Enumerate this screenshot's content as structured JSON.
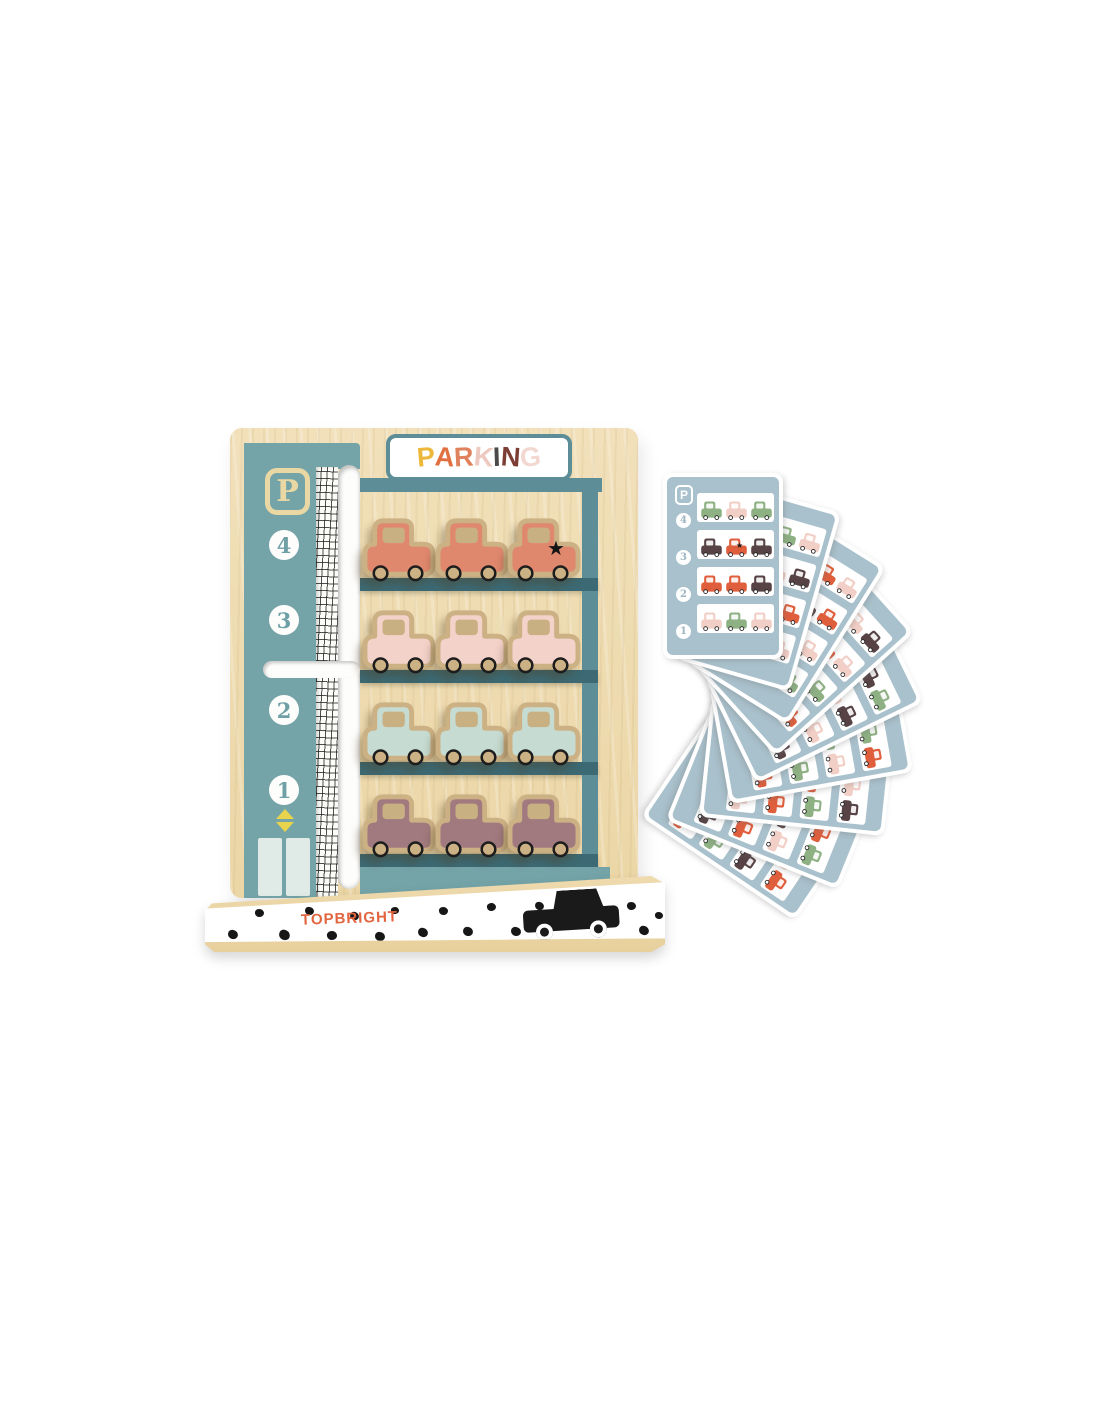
{
  "scene": {
    "description": "Wooden toy parking garage with twelve cars, elevator track, printed pattern cards fanned at right",
    "background_color": "#ffffff"
  },
  "sign": {
    "text": "PARKING",
    "letters": [
      {
        "ch": "P",
        "color": "#ecb83b"
      },
      {
        "ch": "A",
        "color": "#e0703f"
      },
      {
        "ch": "R",
        "color": "#e0815d"
      },
      {
        "ch": "K",
        "color": "#edc9c0"
      },
      {
        "ch": "I",
        "color": "#4a4a4a"
      },
      {
        "ch": "N",
        "color": "#7d3c34"
      },
      {
        "ch": "G",
        "color": "#f2d8d0"
      }
    ],
    "background": "#ffffff",
    "border_color": "#5d8e98"
  },
  "pillar": {
    "symbol": "P",
    "floors": [
      "4",
      "3",
      "2",
      "1"
    ],
    "teal": "#74a4a8",
    "badge_color": "#e9d7a4",
    "numeral_color": "#6ea0a6"
  },
  "garage": {
    "wood_color": "#eedcb2",
    "roof_teal": "#5d8e98",
    "shelf_teal": "#3c6973",
    "car_outline": "#ccb185",
    "car_window": "#c9b083",
    "star_char": "★",
    "rows": [
      {
        "floor": "4",
        "car_color": "#e0886e",
        "cars": [
          {
            "star": false
          },
          {
            "star": false
          },
          {
            "star": true
          }
        ]
      },
      {
        "floor": "3",
        "car_color": "#f3d2ca",
        "cars": [
          {
            "star": false
          },
          {
            "star": false
          },
          {
            "star": false
          }
        ]
      },
      {
        "floor": "2",
        "car_color": "#c6dcd2",
        "cars": [
          {
            "star": false
          },
          {
            "star": false
          },
          {
            "star": false
          }
        ]
      },
      {
        "floor": "1",
        "car_color": "#a17a7f",
        "cars": [
          {
            "star": false
          },
          {
            "star": false
          },
          {
            "star": false
          }
        ]
      }
    ]
  },
  "elevator": {
    "up_arrow": "▲",
    "down_arrow": "▼",
    "arrow_color": "#e8d44c",
    "door_color": "#e0eae6"
  },
  "base": {
    "brand": "TOPBRIGHT",
    "brand_color": "#e2653f",
    "face_color": "#ffffff",
    "wood_color": "#e9d2a0",
    "car_color": "#1a1a1a",
    "dots": [
      [
        23,
        54,
        10,
        10
      ],
      [
        50,
        33,
        9,
        -8
      ],
      [
        74,
        54,
        11,
        20
      ],
      [
        100,
        31,
        9,
        5
      ],
      [
        122,
        55,
        10,
        -12
      ],
      [
        145,
        36,
        9,
        14
      ],
      [
        170,
        56,
        10,
        4
      ],
      [
        186,
        31,
        8,
        -10
      ],
      [
        213,
        52,
        10,
        12
      ],
      [
        234,
        31,
        9,
        -6
      ],
      [
        258,
        51,
        10,
        8
      ],
      [
        282,
        27,
        9,
        -14
      ],
      [
        306,
        51,
        10,
        6
      ],
      [
        330,
        26,
        9,
        10
      ],
      [
        422,
        26,
        9,
        -8
      ],
      [
        434,
        50,
        10,
        12
      ],
      [
        450,
        36,
        8,
        0
      ]
    ]
  },
  "cards": {
    "symbol": "P",
    "floors": [
      "4",
      "3",
      "2",
      "1"
    ],
    "panel_color": "#a9c1cc",
    "row_color": "#ffffff",
    "palette": {
      "g": "#8eb184",
      "p": "#f2cfc6",
      "r": "#df5f3d",
      "b": "#574346"
    },
    "deck": [
      {
        "angle": 0,
        "rows": [
          [
            "g",
            "p",
            "g"
          ],
          [
            "b",
            "r*",
            "b"
          ],
          [
            "r",
            "r",
            "b"
          ],
          [
            "p",
            "g",
            "p"
          ]
        ]
      },
      {
        "angle": 16,
        "rows": [
          [
            "p",
            "g",
            "p"
          ],
          [
            "b",
            "p",
            "b"
          ],
          [
            "r",
            "g",
            "r"
          ],
          [
            "g",
            "b",
            "p"
          ]
        ]
      },
      {
        "angle": 32,
        "rows": [
          [
            "g",
            "r",
            "p"
          ],
          [
            "p",
            "b",
            "r"
          ],
          [
            "b",
            "g",
            "p"
          ],
          [
            "r",
            "p",
            "g"
          ]
        ]
      },
      {
        "angle": 48,
        "rows": [
          [
            "r",
            "p",
            "b"
          ],
          [
            "g",
            "r*",
            "p"
          ],
          [
            "p",
            "b",
            "g"
          ],
          [
            "b",
            "g",
            "r"
          ]
        ]
      },
      {
        "angle": 64,
        "rows": [
          [
            "p",
            "b",
            "g"
          ],
          [
            "r",
            "p",
            "b"
          ],
          [
            "g",
            "r",
            "p"
          ],
          [
            "p",
            "g",
            "b"
          ]
        ]
      },
      {
        "angle": 80,
        "rows": [
          [
            "b",
            "g",
            "r"
          ],
          [
            "p",
            "g",
            "p"
          ],
          [
            "r",
            "b",
            "g"
          ],
          [
            "g",
            "p",
            "r"
          ]
        ]
      },
      {
        "angle": 96,
        "rows": [
          [
            "g",
            "p",
            "b"
          ],
          [
            "b",
            "r",
            "g"
          ],
          [
            "p",
            "g",
            "r"
          ],
          [
            "r",
            "b",
            "p"
          ]
        ]
      },
      {
        "angle": 112,
        "rows": [
          [
            "p",
            "r",
            "g"
          ],
          [
            "g",
            "b",
            "p"
          ],
          [
            "b",
            "p",
            "r"
          ],
          [
            "g",
            "r",
            "b"
          ]
        ]
      },
      {
        "angle": 124,
        "rows": [
          [
            "b",
            "p",
            "r"
          ],
          [
            "r",
            "g",
            "b"
          ],
          [
            "g",
            "p",
            "g"
          ],
          [
            "p",
            "b",
            "r"
          ]
        ]
      }
    ]
  }
}
